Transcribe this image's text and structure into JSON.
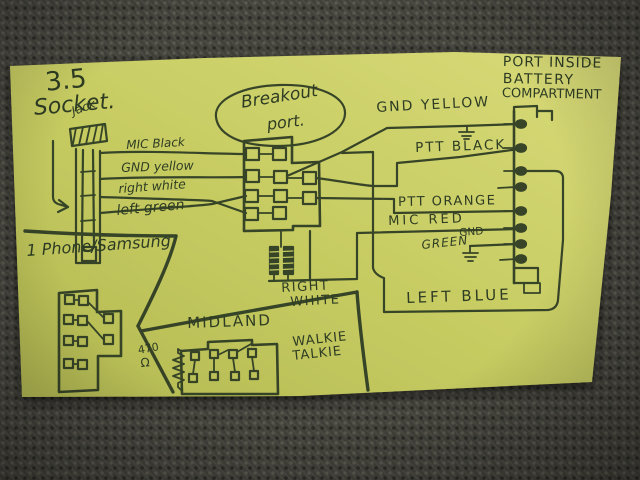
{
  "colors": {
    "paper": "#c9ce66",
    "ink": "#2e3c24",
    "fabric": "#45443d"
  },
  "diagram": {
    "socket": {
      "size_label": "3.5",
      "name_label": "Socket.",
      "jack_label": "Jack",
      "wires": [
        {
          "label": "MIC Black"
        },
        {
          "label": "GND yellow"
        },
        {
          "label": "right white"
        },
        {
          "label": "left green"
        }
      ]
    },
    "breakout": {
      "title_line1": "Breakout",
      "title_line2": "port."
    },
    "battery_port": {
      "title_line1": "PORT INSIDE",
      "title_line2": "BATTERY",
      "title_line3": "COMPARTMENT"
    },
    "connections": {
      "gnd_yellow": "GND YELLOW",
      "ptt_black": "PTT BLACK",
      "ptt_orange": "PTT ORANGE",
      "mic_red": "MIC RED",
      "green": "GREEN",
      "gnd": "GND",
      "right_line1": "RIGHT",
      "right_line2": "WHITE",
      "left_blue": "LEFT BLUE"
    },
    "phone": {
      "label": "1 Phone/Samsung"
    },
    "radio": {
      "brand": "MIDLAND",
      "device_line1": "WALKIE",
      "device_line2": "TALKIE",
      "resistor_value": "470",
      "resistor_unit": "Ω"
    }
  }
}
